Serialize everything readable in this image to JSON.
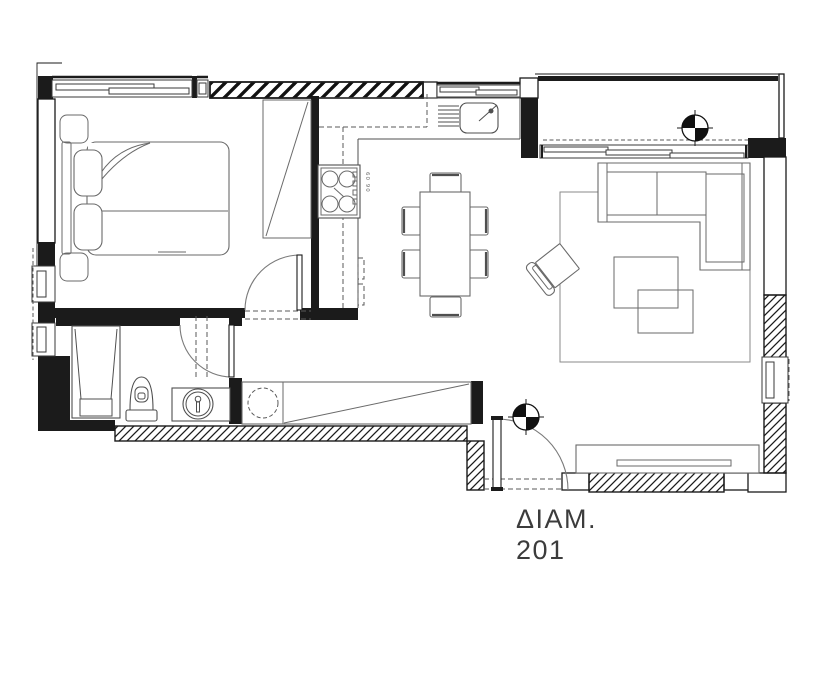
{
  "apartment_label": {
    "line1": "ΔΙΑΜ.",
    "line2": "201"
  },
  "stove": {
    "dimension_label": "60 90"
  },
  "colors": {
    "wall": "#1b1b1b",
    "window": "#3a3a3a",
    "furniture": "#6a6a6a",
    "fixture": "#4f4f4f",
    "dash": "#5a5a5a",
    "rug": "#8a8a8a",
    "door": "#7a7a7a",
    "label": "#3c3c3c",
    "background": "#ffffff"
  }
}
